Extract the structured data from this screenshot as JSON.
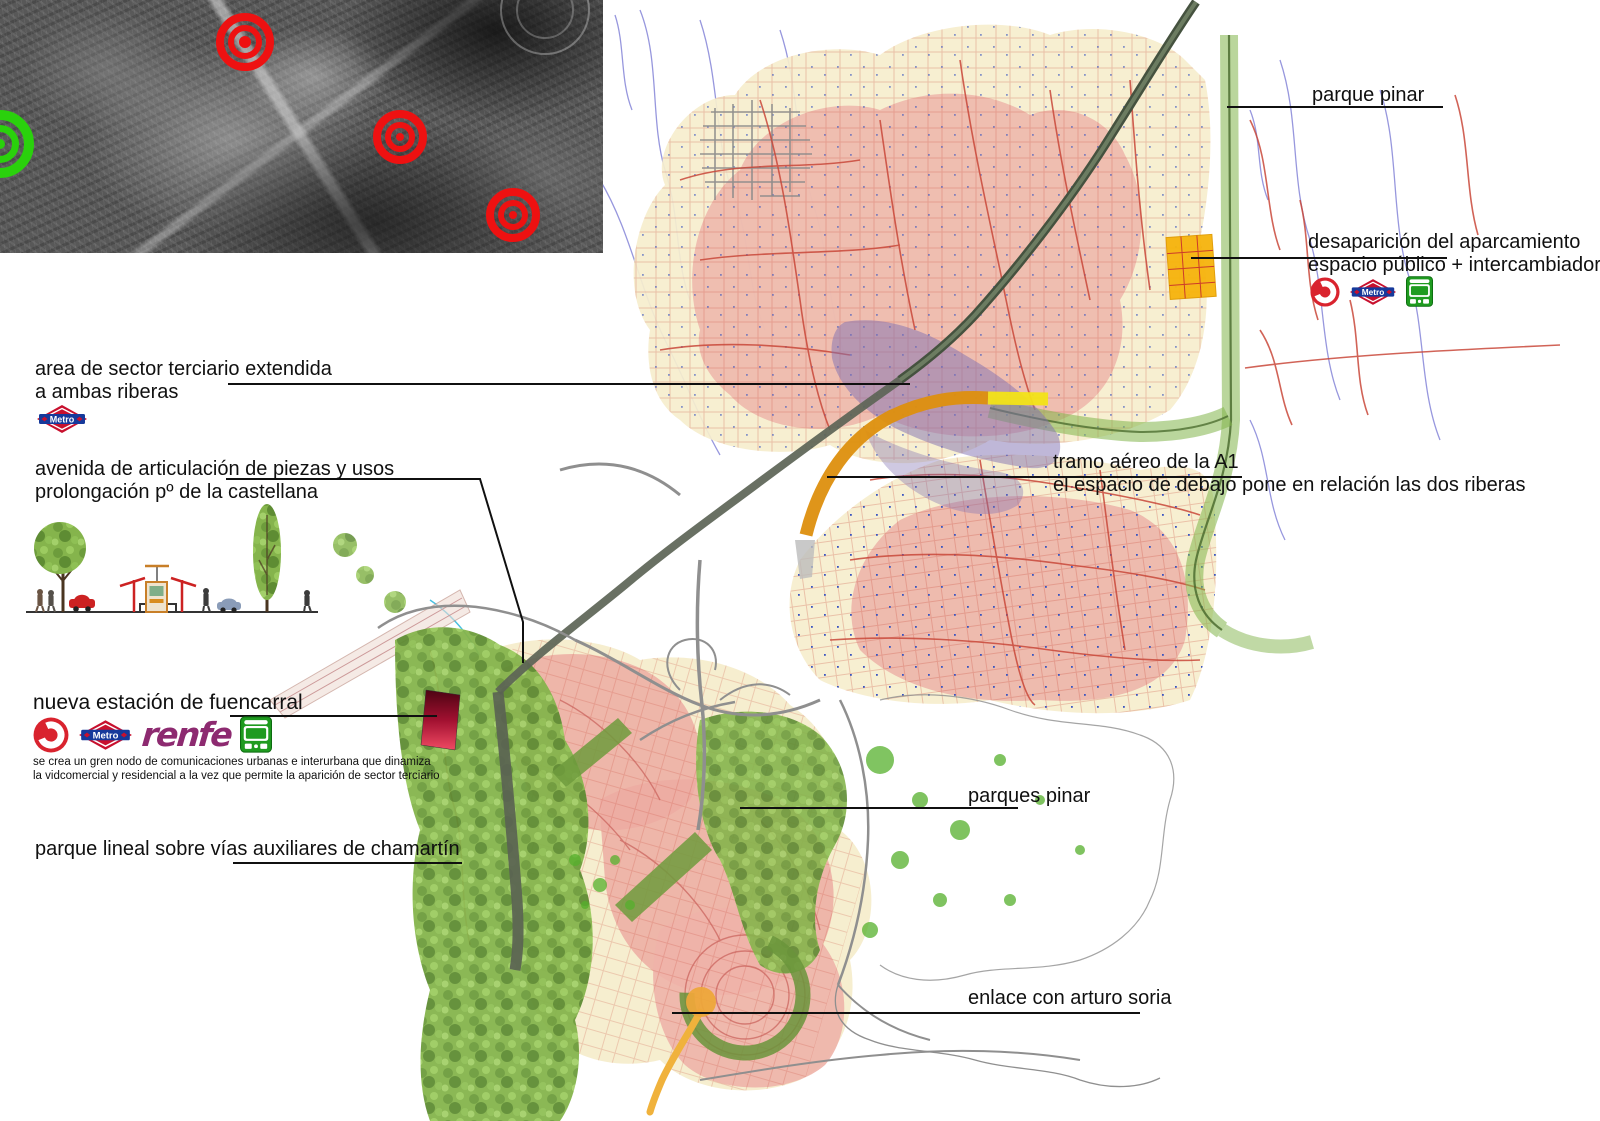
{
  "annotations": {
    "parque_pinar": "parque pinar",
    "desaparicion_line1": "desaparición del aparcamiento",
    "desaparicion_line2": "espacio público + intercambiador",
    "sector_line1": "area de sector terciario extendida",
    "sector_line2": "a ambas riberas",
    "avenida_line1": "avenida de articulación de piezas y usos",
    "avenida_line2": "prolongación pº de la castellana",
    "tramo_line1": "tramo aéreo de la A1",
    "tramo_line2": "el espacio de debajo pone en relación las dos riberas",
    "fuencarral_title": "nueva estación de fuencarral",
    "fuencarral_note1": "se crea un gren nodo de comunicaciones urbanas e interurbana que dinamiza",
    "fuencarral_note2": "la vidcomercial y residencial a la vez que permite la aparición de sector terciario",
    "parque_lineal": "parque lineal sobre vías auxiliares de chamartín",
    "parques_pinar": "parques pinar",
    "enlace": "enlace con arturo soria"
  },
  "icon_labels": {
    "metro": "Metro",
    "renfe": "renfe"
  },
  "colors": {
    "annotation_text": "#101010",
    "leader_line": "#101010",
    "metro_red": "#c8102e",
    "metro_blue": "#16399b",
    "renfe_purple": "#8d2a70",
    "cercanias_red": "#d9232e",
    "bus_green": "#1f9b20",
    "target_red": "#ee1111",
    "target_green": "#2ad10c",
    "park_green": "#85b44c",
    "urban_pink": "#ecb2a8",
    "urban_cream": "#f6eecd",
    "highlight_orange": "#dd8f0e",
    "parking_yellow": "#f6b40c",
    "zone_purple": "#8070b2"
  }
}
